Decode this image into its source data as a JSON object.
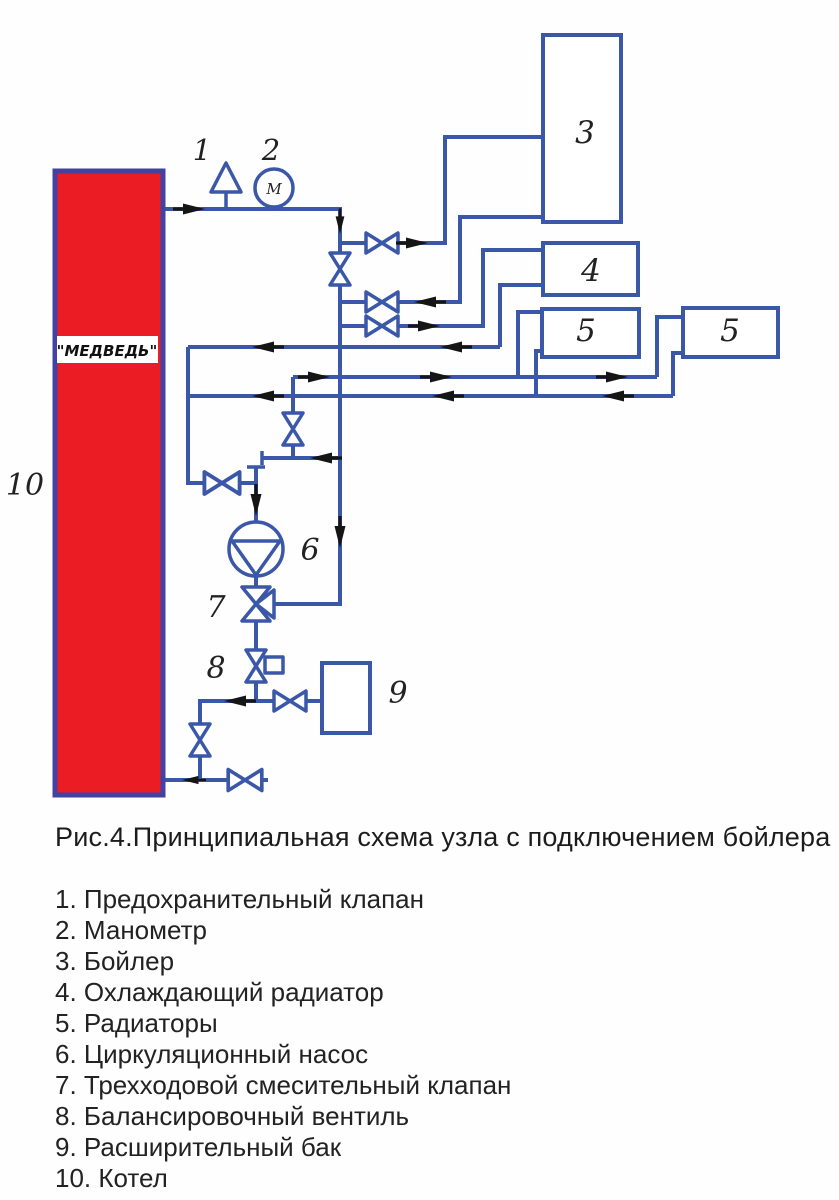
{
  "caption": "Рис.4.Принципиальная схема узла с подключением бойлера",
  "legend": {
    "items": [
      "1. Предохранительный клапан",
      "2. Манометр",
      "3. Бойлер",
      "4. Охлаждающий радиатор",
      "5. Радиаторы",
      "6. Циркуляционный насос",
      "7. Трехходовой смесительный клапан",
      "8. Балансировочный вентиль",
      "9. Расширительный бак",
      "10. Котел"
    ]
  },
  "diagram": {
    "boiler_brand": "\"МЕДВЕДЬ\"",
    "manometer_letter": "М",
    "labels": {
      "safety_valve": "1",
      "manometer": "2",
      "boiler_tank": "3",
      "cooling_radiator": "4",
      "radiator_a": "5",
      "radiator_b": "5",
      "pump": "6",
      "three_way_valve": "7",
      "balancing_valve": "8",
      "expansion_tank": "9",
      "heating_boiler": "10"
    }
  },
  "colors": {
    "pipe_blue": "#3b57a8",
    "boiler_fill": "#ec1c24",
    "boiler_border": "#4341a1",
    "arrow_black": "#151515",
    "background": "#fefefe"
  }
}
